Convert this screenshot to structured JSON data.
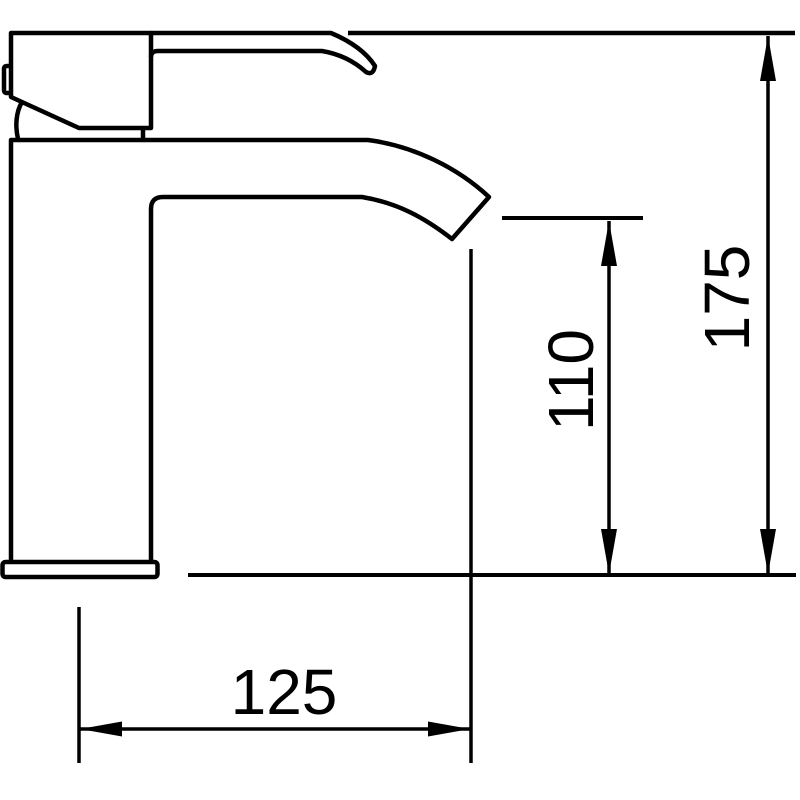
{
  "figure": {
    "name": "single-lever-basin-tap-outline-drawing",
    "line_color": "#000000",
    "background_color": "#ffffff"
  },
  "dimensions": {
    "overall_height": {
      "label": "175"
    },
    "spout_height": {
      "label": "110"
    },
    "spout_reach": {
      "label": "125"
    }
  }
}
